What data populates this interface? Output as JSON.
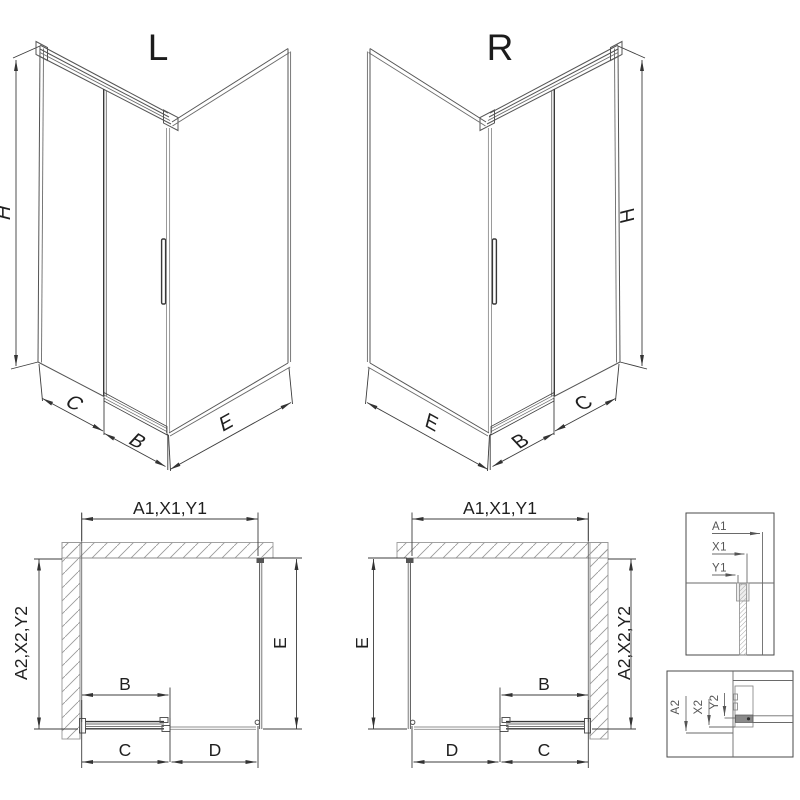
{
  "drawing": {
    "background_color": "#ffffff",
    "line_color": "#555555",
    "hatch_color": "#999999",
    "text_color": "#222222"
  },
  "iso_left": {
    "label": "L",
    "dim_height": "H",
    "dim_fixed": "C",
    "dim_door": "B",
    "dim_side": "E"
  },
  "iso_right": {
    "label": "R",
    "dim_height": "H",
    "dim_fixed": "C",
    "dim_door": "B",
    "dim_side": "E"
  },
  "plan_left": {
    "dim_top": "A1,X1,Y1",
    "dim_left": "A2,X2,Y2",
    "dim_right": "E",
    "dim_door": "B",
    "dim_bottom_left": "C",
    "dim_bottom_right": "D"
  },
  "plan_right": {
    "dim_top": "A1,X1,Y1",
    "dim_right": "A2,X2,Y2",
    "dim_left": "E",
    "dim_door": "B",
    "dim_bottom_left": "D",
    "dim_bottom_right": "C"
  },
  "detail_top": {
    "labels": [
      "A1",
      "X1",
      "Y1"
    ]
  },
  "detail_bottom": {
    "labels": [
      "A2",
      "X2",
      "Y2"
    ]
  }
}
